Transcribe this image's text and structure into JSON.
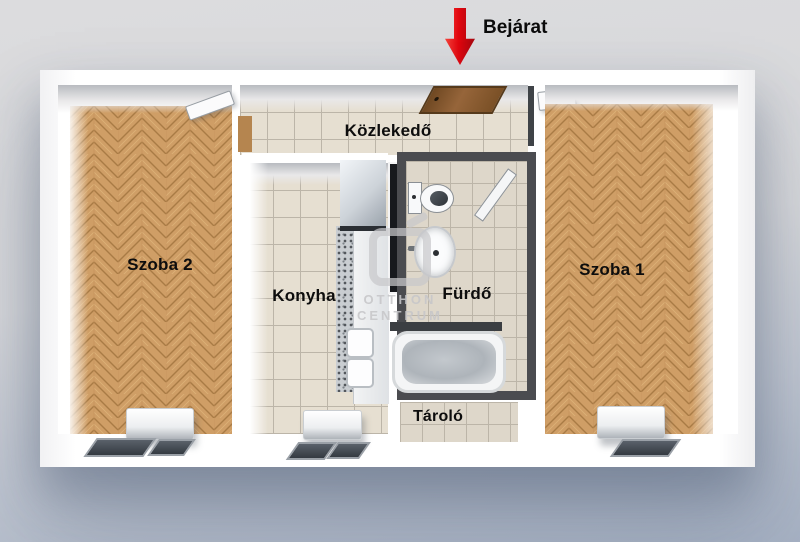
{
  "entrance": {
    "label": "Bejárat"
  },
  "rooms": {
    "hallway": {
      "label": "Közlekedő"
    },
    "room2": {
      "label": "Szoba 2"
    },
    "kitchen": {
      "label": "Konyha"
    },
    "bathroom": {
      "label": "Fürdő"
    },
    "room1": {
      "label": "Szoba 1"
    },
    "storage": {
      "label": "Tároló"
    }
  },
  "watermark": {
    "brand_line1": "OTTHON",
    "brand_line2": "CENTRUM"
  },
  "icons": {
    "entrance_arrow": "arrow-down"
  },
  "colors": {
    "background_top": "#dcdcde",
    "background_bottom": "#a6b1c3",
    "arrow_red": "#e2070f",
    "wood": "#cf9e66",
    "wood_line": "#a97b45",
    "wood_highlight": "#e2b97f",
    "tile": "#e6dfd1",
    "tile_bath": "#ded7ca",
    "tile_line": "#bcb5a8",
    "bathroom_wall": "#4b4c50",
    "cabinet_black": "#17191d",
    "wall_white": "#ffffff",
    "label_color": "#0d0d0d"
  }
}
